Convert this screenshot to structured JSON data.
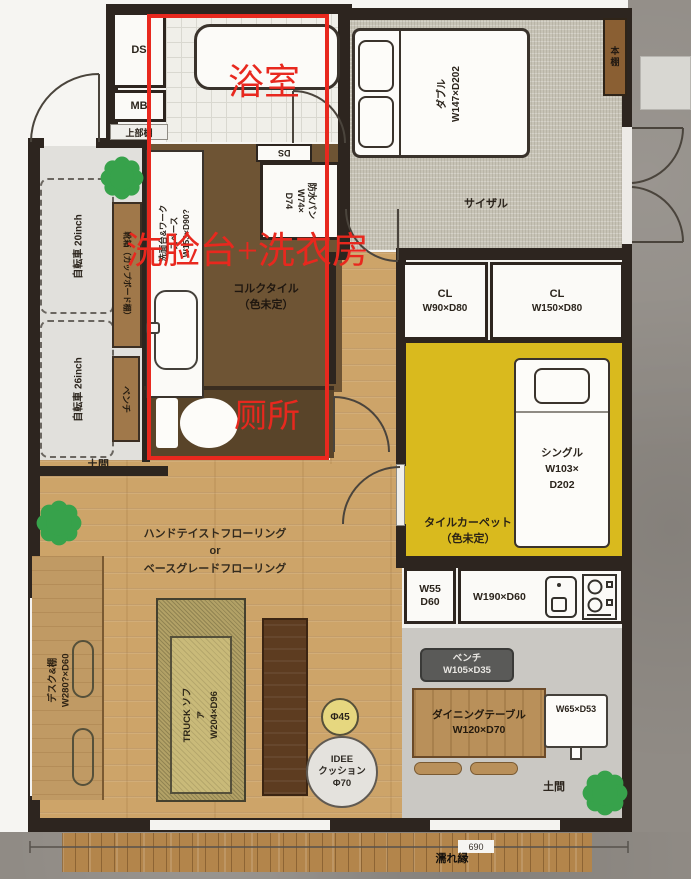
{
  "annotations": {
    "bathroom": "浴室",
    "washroom": "洗脸台+洗衣房",
    "toilet": "厕所",
    "color": "#e8281e"
  },
  "entry": {
    "ds": "DS",
    "mb": "MB",
    "upper_shelf": "上部棚",
    "bike_20": "自転車 20inch",
    "bike_26": "自転車 26inch",
    "shoe_shelf": "靴箱（カップボード棚）",
    "bench": "ベンチ",
    "doma": "土間"
  },
  "washroom": {
    "counter": "洗面台&ワークスペース\nW153×D90?",
    "pan": "防水パン\nW74×\nD74",
    "floor": "コルクタイル\n（色未定）",
    "duct": "DS"
  },
  "bedroom": {
    "bed": "ダブル\nW147×D202",
    "carpet": "サイザル",
    "shelf": "本棚"
  },
  "closets": {
    "cl1_name": "CL",
    "cl1_size": "W90×D80",
    "cl2_name": "CL",
    "cl2_size": "W150×D80"
  },
  "tatami_room": {
    "floor": "タイルカーペット\n（色未定）",
    "bed": "シングル\nW103×\nD202"
  },
  "kitchen": {
    "counter_small": "W55\nD60",
    "counter_main": "W190×D60"
  },
  "dining": {
    "bench": "ベンチ\nW105×D35",
    "table": "ダイニングテーブル\nW120×D70",
    "counter": "W65×D53",
    "doma": "土間"
  },
  "living": {
    "flooring": "ハンドテイストフローリング\nor\nベースグレードフローリング",
    "sofa": "TRUCK ソファ\nW204×D96",
    "desk": "デスク&棚\nW280?×D60",
    "stool": "Φ45",
    "cushion": "IDEE\nクッション\nΦ70"
  },
  "deck": {
    "label": "濡れ縁",
    "dimension": "690"
  },
  "colors": {
    "annotation_red": "#e8281e",
    "tatami_yellow": "#d9ba1e",
    "cork_brown": "#6e5434",
    "wood_floor": "#cda469",
    "wall": "#2d251f"
  }
}
